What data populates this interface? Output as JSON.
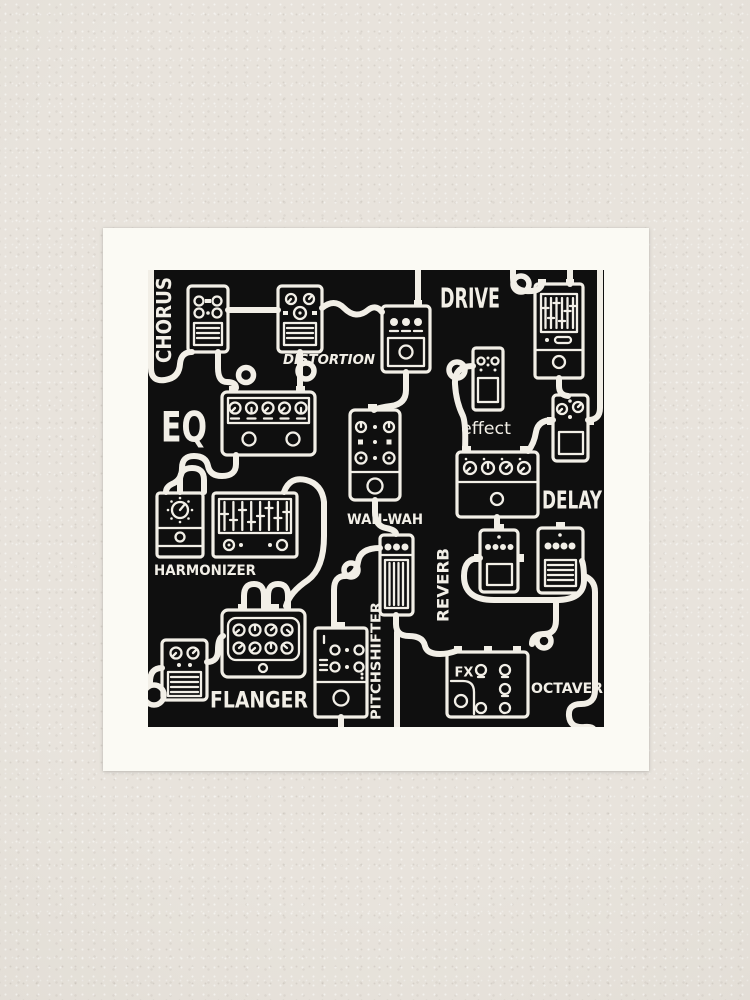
{
  "scene": {
    "wall_color": "#e5e0d8",
    "mat_color": "#fbfaf4",
    "print_background": "#0f0f0f",
    "ink_color": "#f2efe7"
  },
  "artwork": {
    "description": "hand-drawn guitar effect pedals connected by patch cables",
    "labels": {
      "chorus": "CHORUS",
      "distortion": "DISTORTION",
      "drive": "DRIVE",
      "eq": "EQ",
      "effect": "effect",
      "delay": "DELAY",
      "wah_wah": "WAH-WAH",
      "harmonizer": "HARMONIZER",
      "reverb": "REVERB",
      "flanger": "FLANGER",
      "pitchshifter": "PITCHSHIFTER",
      "octaver": "OCTAVER",
      "fx": "FX"
    }
  }
}
